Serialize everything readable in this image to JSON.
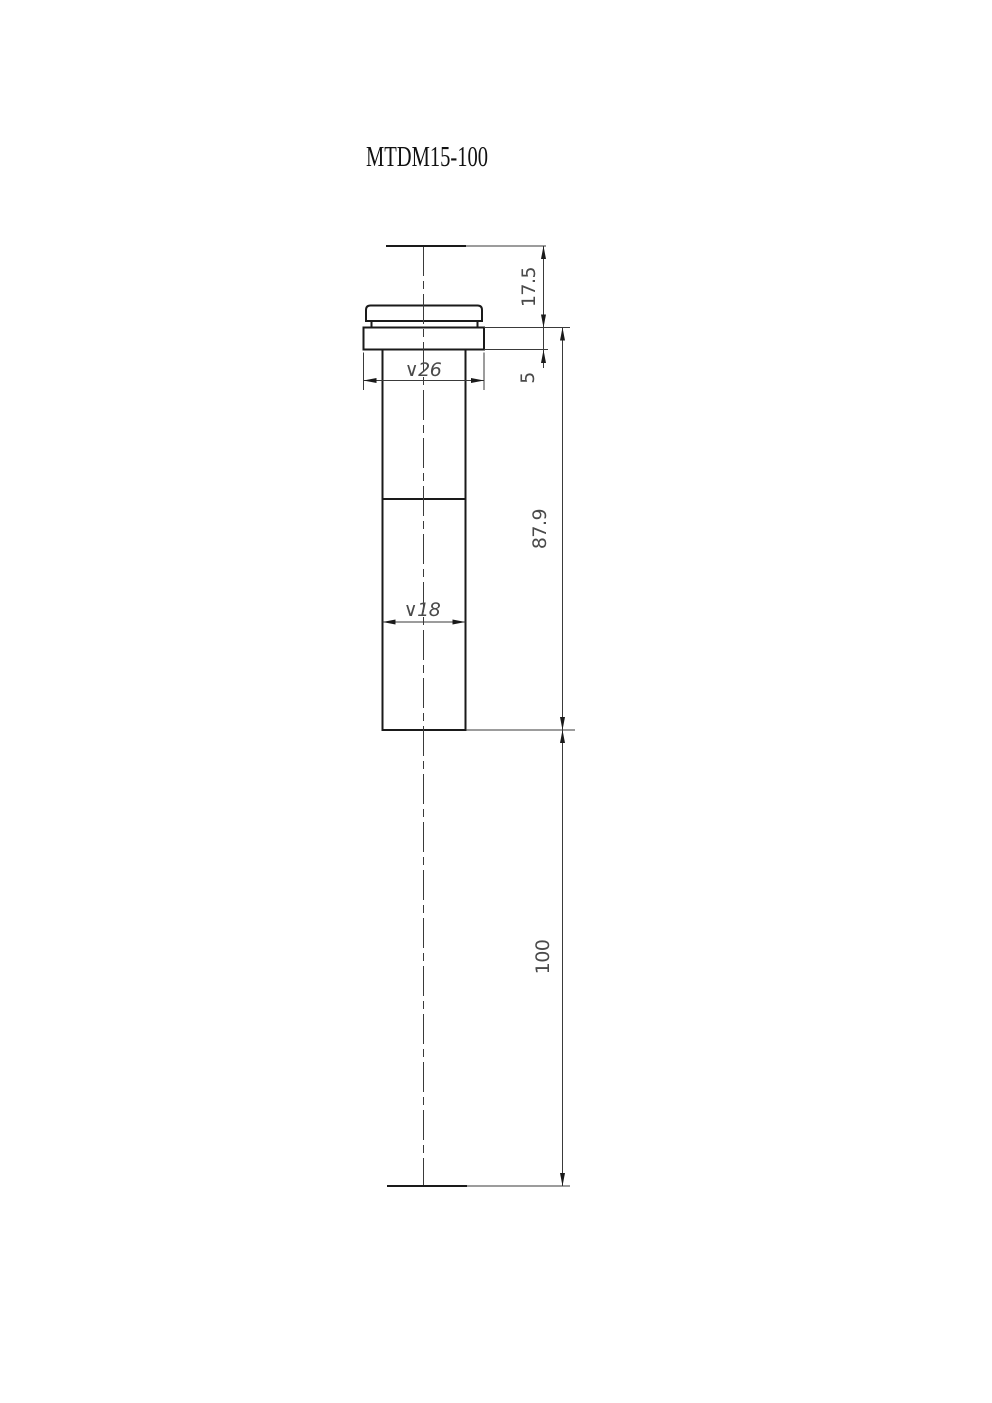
{
  "drawing": {
    "title": "MTDM15-100",
    "dimensions": {
      "top_section_height": "17.5",
      "flange_thickness": "5",
      "flange_diameter": "∨26",
      "body_diameter": "∨18",
      "body_length": "87.9",
      "extension_length": "100"
    },
    "colors": {
      "object_line": "#1a1a1a",
      "thin_line": "#3a3a3a",
      "dimension_text": "#4a4a4a",
      "title_text": "#111111",
      "background": "#ffffff"
    }
  }
}
